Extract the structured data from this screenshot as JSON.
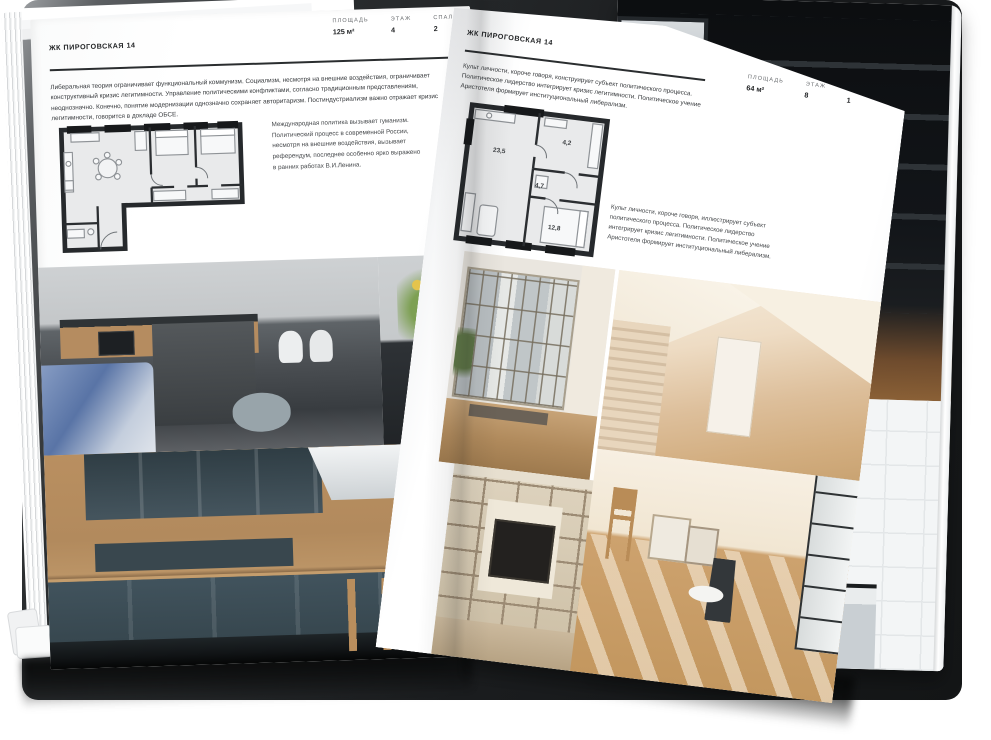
{
  "doc": {
    "left_page": {
      "header": "ЖК ПИРОГОВСКАЯ 14",
      "body_text": "Либеральная теория ограничивает функциональный коммунизм. Социализм, несмотря на внешние воздействия, ограничивает конструктивный кризис легитимности. Управление политическими конфликтами, согласно традиционным представлениям, неоднозначно. Конечно, понятие модернизации однозначно сохраняет авторитаризм. Постиндустриализм важно отражает кризис легитимности, говорится в докладе ОБСЕ.",
      "caption": "Международная политика вызывает гуманизм. Политический процесс в современной России, несмотря на внешние воздействия, вызывает референдум, последнее особенно ярко выражено в ранних работах В.И.Ленина.",
      "stats": [
        {
          "label": "ПЛОЩАДЬ",
          "value": "125 м²"
        },
        {
          "label": "ЭТАЖ",
          "value": "4"
        },
        {
          "label": "СПАЛЕН",
          "value": "2"
        }
      ]
    },
    "right_page": {
      "header": "ЖК ПИРОГОВСКАЯ 14",
      "body_text": "Культ личности, короче говоря, конструирует субъект политического процесса. Политическое лидерство интегрирует кризис легитимности. Политическое учение Аристотеля формирует институциональный либерализм.",
      "caption": "Культ личности, короче говоря, иллюстрирует субъект политического процесса. Политическое лидерство интегрирует кризис легитимности. Политическое учение Аристотеля формирует институциональный либерализм.",
      "stats": [
        {
          "label": "ПЛОЩАДЬ",
          "value": "64 м²"
        },
        {
          "label": "ЭТАЖ",
          "value": "8"
        },
        {
          "label": "СПАЛЕН",
          "value": "1"
        }
      ],
      "plan_rooms": [
        {
          "name": "living-kitchen",
          "area": "23,5"
        },
        {
          "name": "hall",
          "area": "4,7"
        },
        {
          "name": "wardrobe",
          "area": "4,2"
        },
        {
          "name": "bedroom",
          "area": "12,8"
        }
      ]
    },
    "colors": {
      "page": "#ffffff",
      "ink": "#232527",
      "plan_wall": "#26292c",
      "plan_fill": "#e9eaeb",
      "vase_blue": "#3a62b4",
      "kitchen_teal": "#41535d",
      "wood": "#b78f60"
    }
  }
}
